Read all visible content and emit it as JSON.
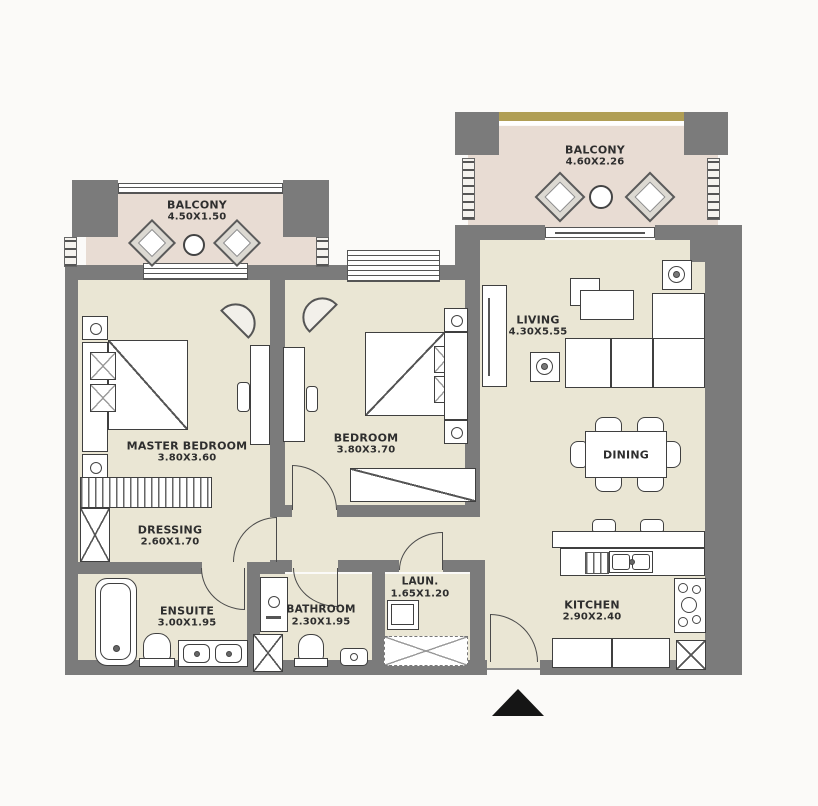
{
  "plan_type": "apartment-floor-plan",
  "rooms": {
    "balcony_left": {
      "name": "BALCONY",
      "dims": "4.50X1.50"
    },
    "balcony_right": {
      "name": "BALCONY",
      "dims": "4.60X2.26"
    },
    "master_bedroom": {
      "name": "MASTER BEDROOM",
      "dims": "3.80X3.60"
    },
    "bedroom": {
      "name": "BEDROOM",
      "dims": "3.80X3.70"
    },
    "living": {
      "name": "LIVING",
      "dims": "4.30X5.55"
    },
    "dining": {
      "name": "DINING",
      "dims": ""
    },
    "dressing": {
      "name": "DRESSING",
      "dims": "2.60X1.70"
    },
    "ensuite": {
      "name": "ENSUITE",
      "dims": "3.00X1.95"
    },
    "bathroom": {
      "name": "BATHROOM",
      "dims": "2.30X1.95"
    },
    "laundry": {
      "name": "LAUN.",
      "dims": "1.65X1.20"
    },
    "kitchen": {
      "name": "KITCHEN",
      "dims": "2.90X2.40"
    }
  },
  "symbols": {
    "entry_marker": "entrance-arrow",
    "shafts": "x-box-duct",
    "doors": "quarter-circle-swing"
  },
  "colors": {
    "wall": "#7b7b7b",
    "room_floor": "#eae6d4",
    "balcony_floor": "#e8dcd3",
    "balcony_top_band": "#b09e55",
    "line": "#4a4a4a",
    "entry_marker": "#151515",
    "background": "#fbfaf8"
  }
}
